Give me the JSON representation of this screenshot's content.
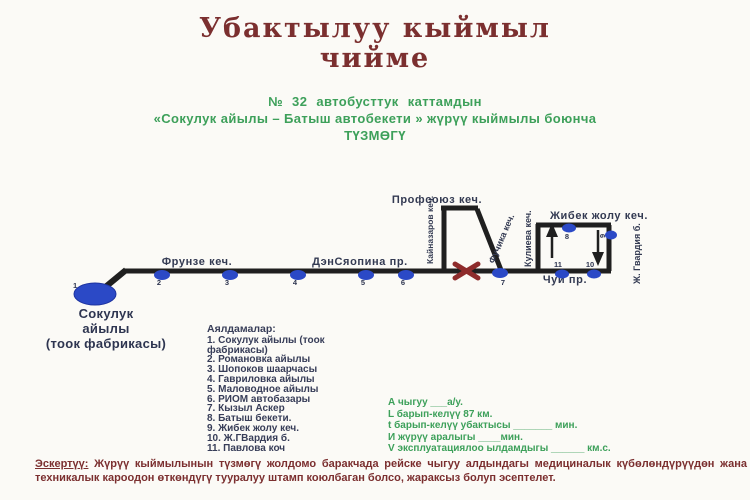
{
  "title": {
    "line1": "Убактылуу кыймыл",
    "line2": "чийме",
    "color": "#7b2f2f"
  },
  "subtitle": {
    "line1": "№ 32  автобусттук  каттамдын",
    "line2": "«Сокулук айылы – Батыш автобекети » жүрүү кыймылы боюнча",
    "line3": "ТҮЗМӨГҮ",
    "color": "#3da05a"
  },
  "diagram": {
    "terminal": {
      "line1": "Сокулук",
      "line2": "айылы",
      "line3": "(тоок фабрикасы)"
    },
    "streets": {
      "frunze": "Фрунзе кеч.",
      "densyaopina": "ДэнСяопина пр.",
      "profsoyuz": "Профсоюз кеч.",
      "kaynazarov": "Кайназаров кеч.",
      "fuchika": "Фучика кеч.",
      "kulieva": "Кулиева кеч.",
      "zhibek": "Жибек жолу кеч.",
      "gvardia": "Ж. Гвардия б.",
      "chuy": "Чуй пр."
    },
    "stops": [
      "1",
      "2",
      "3",
      "4",
      "5",
      "6",
      "7",
      "8",
      "9",
      "10",
      "11"
    ],
    "colors": {
      "route_line": "#1f1f1f",
      "stop_dot": "#2b49c6",
      "closure_x": "#8e2b2b"
    }
  },
  "legend": {
    "title": "Аялдамалар:",
    "items": [
      "1. Сокулук айылы (тоок фабрикасы)",
      "2. Романовка айылы",
      "3. Шопоков шаарчасы",
      "4. Гавриловка айылы",
      "5. Маловодное айылы",
      "6. РИОМ автобазары",
      "7. Кызыл Аскер",
      "8. Батыш бекети.",
      "9. Жибек жолу кеч.",
      "10. Ж.ГВардия б.",
      "11. Павлова коч"
    ]
  },
  "metrics": {
    "lines": [
      "А чыгуу ___а/у.",
      "L барып-келүү  87 км.",
      "t барып-келүү убактысы _______ мин.",
      "И жүрүү аралыгы ____мин.",
      "V эксплуатациялоо ылдамдыгы ______ км.с."
    ]
  },
  "note": {
    "label": "Эскертүү:",
    "text": " Жүрүү кыймылынын түзмөгү жолдомо баракчада рейске чыгуу алдындагы медициналык күбөлөндүрүүдөн жана техникалык кароодон өткөндүгү тууралуу штамп коюлбаган болсо, жараксыз болуп эсептелет."
  }
}
